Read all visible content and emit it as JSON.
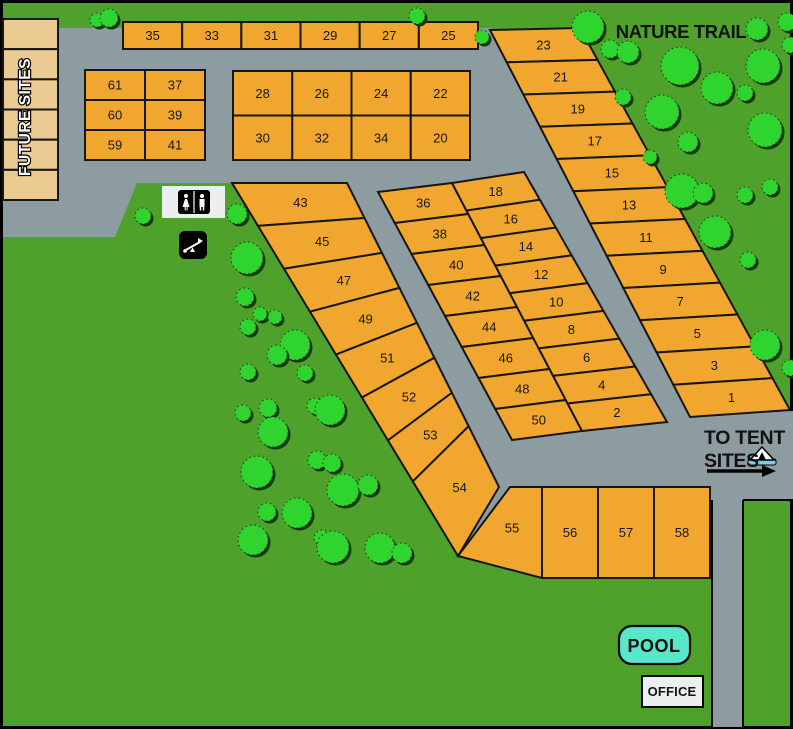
{
  "title": "Campground Site Map",
  "colors": {
    "grass": "#4EA22C",
    "road": "#8D9CA1",
    "site": "#F1A72F",
    "site_stroke": "#161616",
    "tan": "#EACB92",
    "tree": "#2FD42F",
    "tree_shadow": "#16380A",
    "pool": "#58E8C9",
    "office": "#ECEFEF",
    "tent_base": "#85CBE8",
    "label": "#121212",
    "white": "#FFFFFF",
    "black": "#000000"
  },
  "labels": {
    "nature_trail": "NATURE TRAIL",
    "future_sites": "FUTURE SITES",
    "to_tent_line1": "TO TENT",
    "to_tent_line2": "SITES",
    "pool": "POOL",
    "office": "OFFICE"
  },
  "roads": {
    "main": [
      [
        58,
        28
      ],
      [
        492,
        28
      ],
      [
        690,
        417
      ],
      [
        793,
        411
      ],
      [
        793,
        500
      ],
      [
        743,
        500
      ],
      [
        743,
        727
      ],
      [
        712,
        727
      ],
      [
        712,
        500
      ],
      [
        510,
        500
      ],
      [
        458,
        556
      ],
      [
        232,
        183
      ],
      [
        137,
        183
      ],
      [
        115,
        237
      ],
      [
        3,
        237
      ],
      [
        3,
        200
      ],
      [
        58,
        200
      ]
    ],
    "edge_lines": [
      [
        712,
        500,
        712,
        729
      ],
      [
        743,
        500,
        743,
        729
      ],
      [
        743,
        500,
        793,
        500
      ]
    ]
  },
  "site_groups": [
    {
      "name": "future-sites-column",
      "kind": "grid",
      "x": 3,
      "y": 19,
      "w": 55,
      "h": 181,
      "cols": 1,
      "rows": 6,
      "fill": "tan",
      "labels": [
        "",
        "",
        "",
        "",
        "",
        ""
      ]
    },
    {
      "name": "top-row",
      "kind": "grid",
      "x": 123,
      "y": 22,
      "w": 355,
      "h": 27,
      "cols": 6,
      "rows": 1,
      "labels": [
        "35",
        "33",
        "31",
        "29",
        "27",
        "25"
      ]
    },
    {
      "name": "block-61",
      "kind": "grid",
      "x": 85,
      "y": 70,
      "w": 120,
      "h": 90,
      "cols": 2,
      "rows": 3,
      "labels": [
        "61",
        "37",
        "60",
        "39",
        "59",
        "41"
      ]
    },
    {
      "name": "block-28",
      "kind": "grid",
      "x": 233,
      "y": 71,
      "w": 237,
      "h": 89,
      "cols": 4,
      "rows": 2,
      "labels": [
        "28",
        "26",
        "24",
        "22",
        "30",
        "32",
        "34",
        "20"
      ]
    },
    {
      "name": "strip-23-1",
      "kind": "strip",
      "lt": [
        490,
        30
      ],
      "lb": [
        690,
        417
      ],
      "rt": [
        580,
        28
      ],
      "rb": [
        790,
        410
      ],
      "labels": [
        "23",
        "21",
        "19",
        "17",
        "15",
        "13",
        "11",
        "9",
        "7",
        "5",
        "3",
        "1"
      ]
    },
    {
      "name": "strip-43-54",
      "kind": "strip",
      "lt": [
        232,
        183
      ],
      "lb": [
        458,
        556
      ],
      "rt": [
        347,
        183
      ],
      "rb": [
        499,
        487
      ],
      "fracs": [
        0,
        0.115,
        0.23,
        0.345,
        0.46,
        0.575,
        0.69,
        0.8,
        1
      ],
      "labels": [
        "43",
        "45",
        "47",
        "49",
        "51",
        "52",
        "53",
        "54"
      ]
    },
    {
      "name": "mid-block-left",
      "kind": "strip",
      "lt": [
        378,
        192
      ],
      "lb": [
        512,
        440
      ],
      "rt": [
        452,
        183
      ],
      "rb": [
        582,
        431
      ],
      "labels": [
        "36",
        "38",
        "40",
        "42",
        "44",
        "46",
        "48",
        "50"
      ]
    },
    {
      "name": "mid-block-right",
      "kind": "strip",
      "lt": [
        452,
        183
      ],
      "lb": [
        582,
        431
      ],
      "rt": [
        524,
        172
      ],
      "rb": [
        667,
        422
      ],
      "labels": [
        "18",
        "16",
        "14",
        "12",
        "10",
        "8",
        "6",
        "4",
        "2"
      ]
    },
    {
      "name": "site-55",
      "kind": "poly",
      "points": [
        [
          510,
          487
        ],
        [
          542,
          487
        ],
        [
          542,
          578
        ],
        [
          458,
          556
        ]
      ],
      "label_at": [
        512,
        528
      ],
      "labels": [
        "55"
      ]
    },
    {
      "name": "bottom-row",
      "kind": "grid",
      "x": 542,
      "y": 487,
      "w": 168,
      "h": 91,
      "cols": 3,
      "rows": 1,
      "labels": [
        "56",
        "57",
        "58"
      ]
    }
  ],
  "trees": [
    [
      97,
      20,
      7
    ],
    [
      109,
      18,
      9
    ],
    [
      417,
      16,
      8
    ],
    [
      482,
      37,
      7
    ],
    [
      588,
      27,
      16
    ],
    [
      610,
      49,
      9
    ],
    [
      628,
      52,
      11
    ],
    [
      787,
      22,
      9
    ],
    [
      757,
      29,
      11
    ],
    [
      790,
      45,
      8
    ],
    [
      680,
      66,
      19
    ],
    [
      763,
      66,
      17
    ],
    [
      717,
      88,
      16
    ],
    [
      745,
      93,
      8
    ],
    [
      623,
      97,
      8
    ],
    [
      662,
      112,
      17
    ],
    [
      688,
      142,
      10
    ],
    [
      650,
      157,
      7
    ],
    [
      765,
      130,
      17
    ],
    [
      682,
      191,
      17
    ],
    [
      703,
      193,
      10
    ],
    [
      745,
      195,
      8
    ],
    [
      770,
      187,
      8
    ],
    [
      715,
      232,
      16
    ],
    [
      748,
      260,
      8
    ],
    [
      765,
      345,
      15
    ],
    [
      790,
      368,
      8
    ],
    [
      143,
      216,
      8
    ],
    [
      237,
      214,
      10
    ],
    [
      247,
      258,
      16
    ],
    [
      245,
      297,
      9
    ],
    [
      260,
      314,
      7
    ],
    [
      275,
      317,
      7
    ],
    [
      248,
      327,
      8
    ],
    [
      295,
      345,
      15
    ],
    [
      277,
      355,
      10
    ],
    [
      248,
      372,
      8
    ],
    [
      305,
      373,
      8
    ],
    [
      243,
      413,
      8
    ],
    [
      268,
      408,
      9
    ],
    [
      315,
      406,
      8
    ],
    [
      330,
      410,
      15
    ],
    [
      273,
      432,
      15
    ],
    [
      257,
      472,
      16
    ],
    [
      317,
      460,
      9
    ],
    [
      332,
      463,
      9
    ],
    [
      343,
      490,
      16
    ],
    [
      368,
      485,
      10
    ],
    [
      297,
      513,
      15
    ],
    [
      267,
      512,
      9
    ],
    [
      253,
      540,
      15
    ],
    [
      322,
      538,
      8
    ],
    [
      333,
      547,
      16
    ],
    [
      380,
      548,
      15
    ],
    [
      402,
      553,
      10
    ]
  ],
  "facilities": {
    "pool_box": {
      "x": 619,
      "y": 626,
      "w": 71,
      "h": 38,
      "r": 13
    },
    "office_box": {
      "x": 642,
      "y": 676,
      "w": 61,
      "h": 31
    },
    "restroom_box": {
      "x": 162,
      "y": 186,
      "w": 63,
      "h": 32
    },
    "playground_box": {
      "x": 179,
      "y": 231,
      "w": 28,
      "h": 28
    },
    "tent_icon": {
      "x": 748,
      "y": 447
    },
    "arrow": {
      "x1": 707,
      "y1": 471,
      "x2": 762,
      "head_x": 776
    }
  },
  "texts": [
    {
      "name": "nature-trail-label",
      "key": "nature_trail",
      "x": 681,
      "y": 38,
      "size": 18.5,
      "anchor": "middle",
      "weight": "800",
      "ls": "-0.4"
    },
    {
      "name": "future-sites-label",
      "key": "future_sites",
      "x": 30,
      "y": 117,
      "size": 15.5,
      "anchor": "middle",
      "weight": "700",
      "rotate": -90,
      "outline": true,
      "ls": "0.5"
    },
    {
      "name": "to-tent-line1",
      "key": "to_tent_line1",
      "x": 704,
      "y": 444,
      "size": 19.5,
      "anchor": "start",
      "weight": "800",
      "ls": "-0.3"
    },
    {
      "name": "to-tent-line2",
      "key": "to_tent_line2",
      "x": 704,
      "y": 467,
      "size": 19.5,
      "anchor": "start",
      "weight": "800",
      "ls": "-0.3"
    },
    {
      "name": "pool-label",
      "key": "pool",
      "x": 654,
      "y": 652,
      "size": 18,
      "anchor": "middle",
      "weight": "800",
      "ls": "0.5"
    },
    {
      "name": "office-label",
      "key": "office",
      "x": 672,
      "y": 696,
      "size": 13,
      "anchor": "middle",
      "weight": "800",
      "ls": "0.2"
    }
  ]
}
